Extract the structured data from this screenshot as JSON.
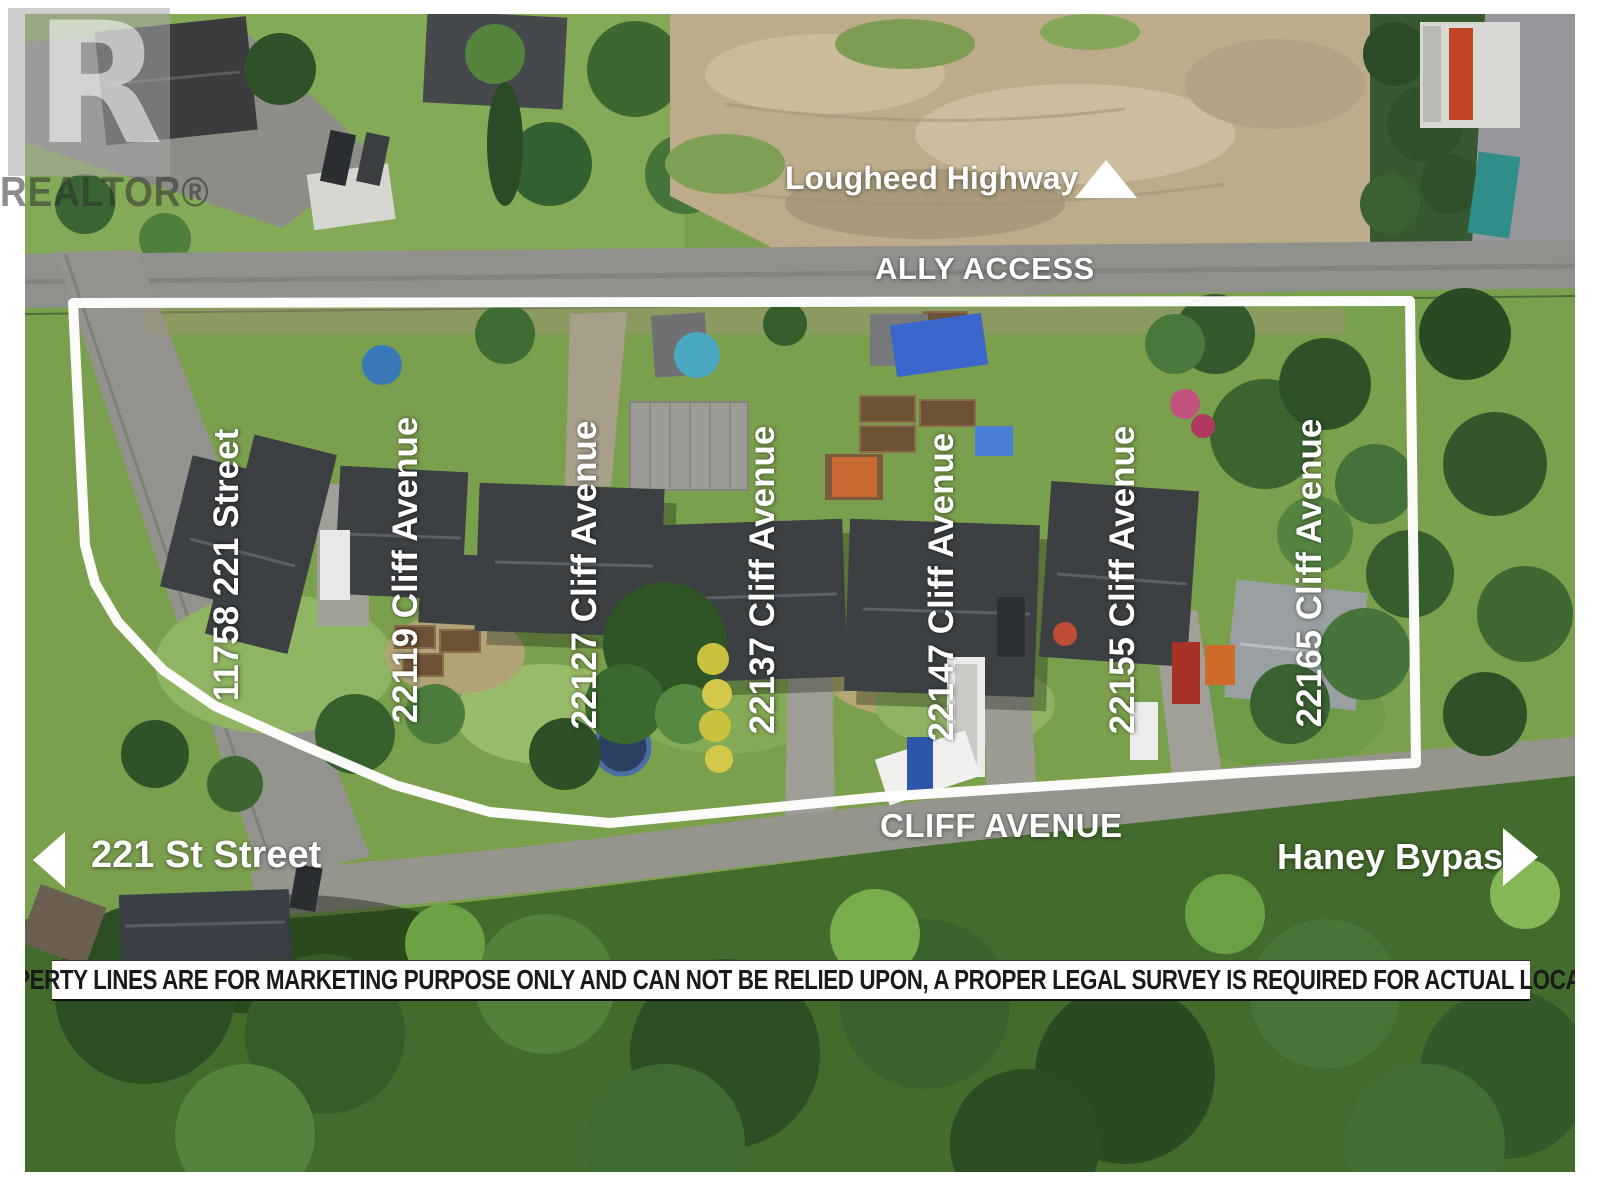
{
  "watermark": {
    "letter": "R",
    "brand": "REALTOR®"
  },
  "labels": {
    "top_highway": "Lougheed Highway",
    "alley": "ALLY ACCESS",
    "bottom_street": "CLIFF AVENUE",
    "left_street": "221 St Street",
    "right_street": "Haney Bypass"
  },
  "properties": [
    {
      "address": "11758 221 Street"
    },
    {
      "address": "22119 Cliff Avenue"
    },
    {
      "address": "22127 Cliff Avenue"
    },
    {
      "address": "22137 Cliff Avenue"
    },
    {
      "address": "22147 Cliff Avenue"
    },
    {
      "address": "22155 Cliff Avenue"
    },
    {
      "address": "22165 Cliff Avenue"
    }
  ],
  "disclaimer": "**PROPERTY LINES ARE FOR MARKETING PURPOSE ONLY AND CAN NOT BE RELIED UPON,  A PROPER LEGAL SURVEY IS REQUIRED FOR ACTUAL LOCATION",
  "colors": {
    "label_text": "#ffffff",
    "outline": "#ffffff",
    "disclaimer_bg": "#ffffff",
    "disclaimer_text": "#1a1a1a"
  }
}
